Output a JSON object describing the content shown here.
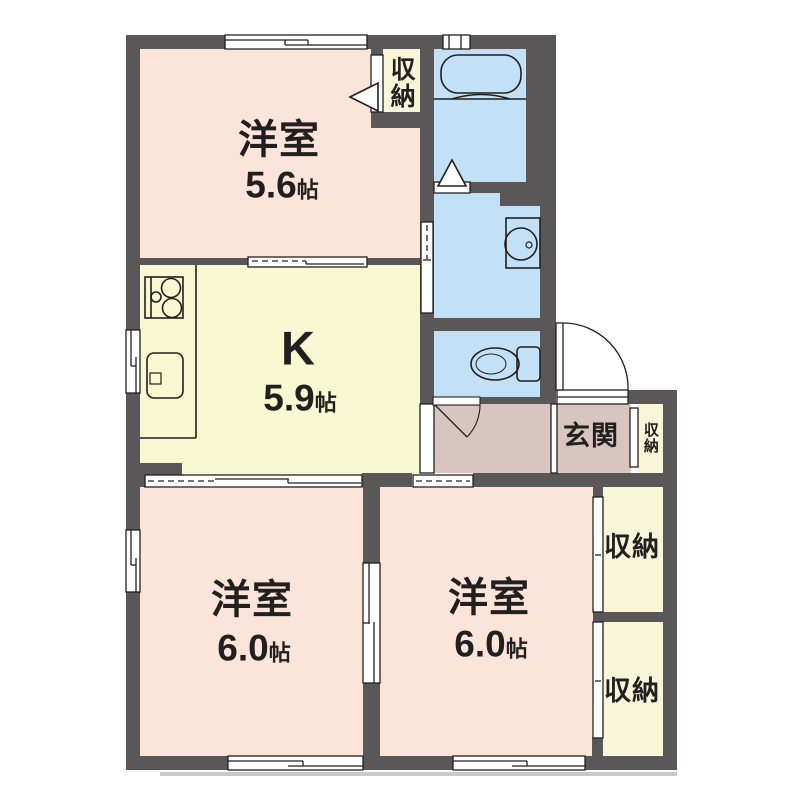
{
  "colors": {
    "bg": "#ffffff",
    "wall": "#595757",
    "line": "#221f1f",
    "room": "#fbe4da",
    "kitchen": "#f8f8d2",
    "water": "#c3e1f6",
    "closet": "#f9f5d9",
    "entry": "#d8c5c0",
    "shadow": "#c9c9c9"
  },
  "rooms": {
    "west1": {
      "name": "洋室",
      "size": "5.6",
      "unit": "帖"
    },
    "kitchen": {
      "name": "K",
      "size": "5.9",
      "unit": "帖"
    },
    "west2": {
      "name": "洋室",
      "size": "6.0",
      "unit": "帖"
    },
    "west3": {
      "name": "洋室",
      "size": "6.0",
      "unit": "帖"
    }
  },
  "entry": {
    "label": "玄関"
  },
  "closets": {
    "top": "収納",
    "entry": "収納",
    "east_upper": "収納",
    "east_lower": "収納"
  }
}
